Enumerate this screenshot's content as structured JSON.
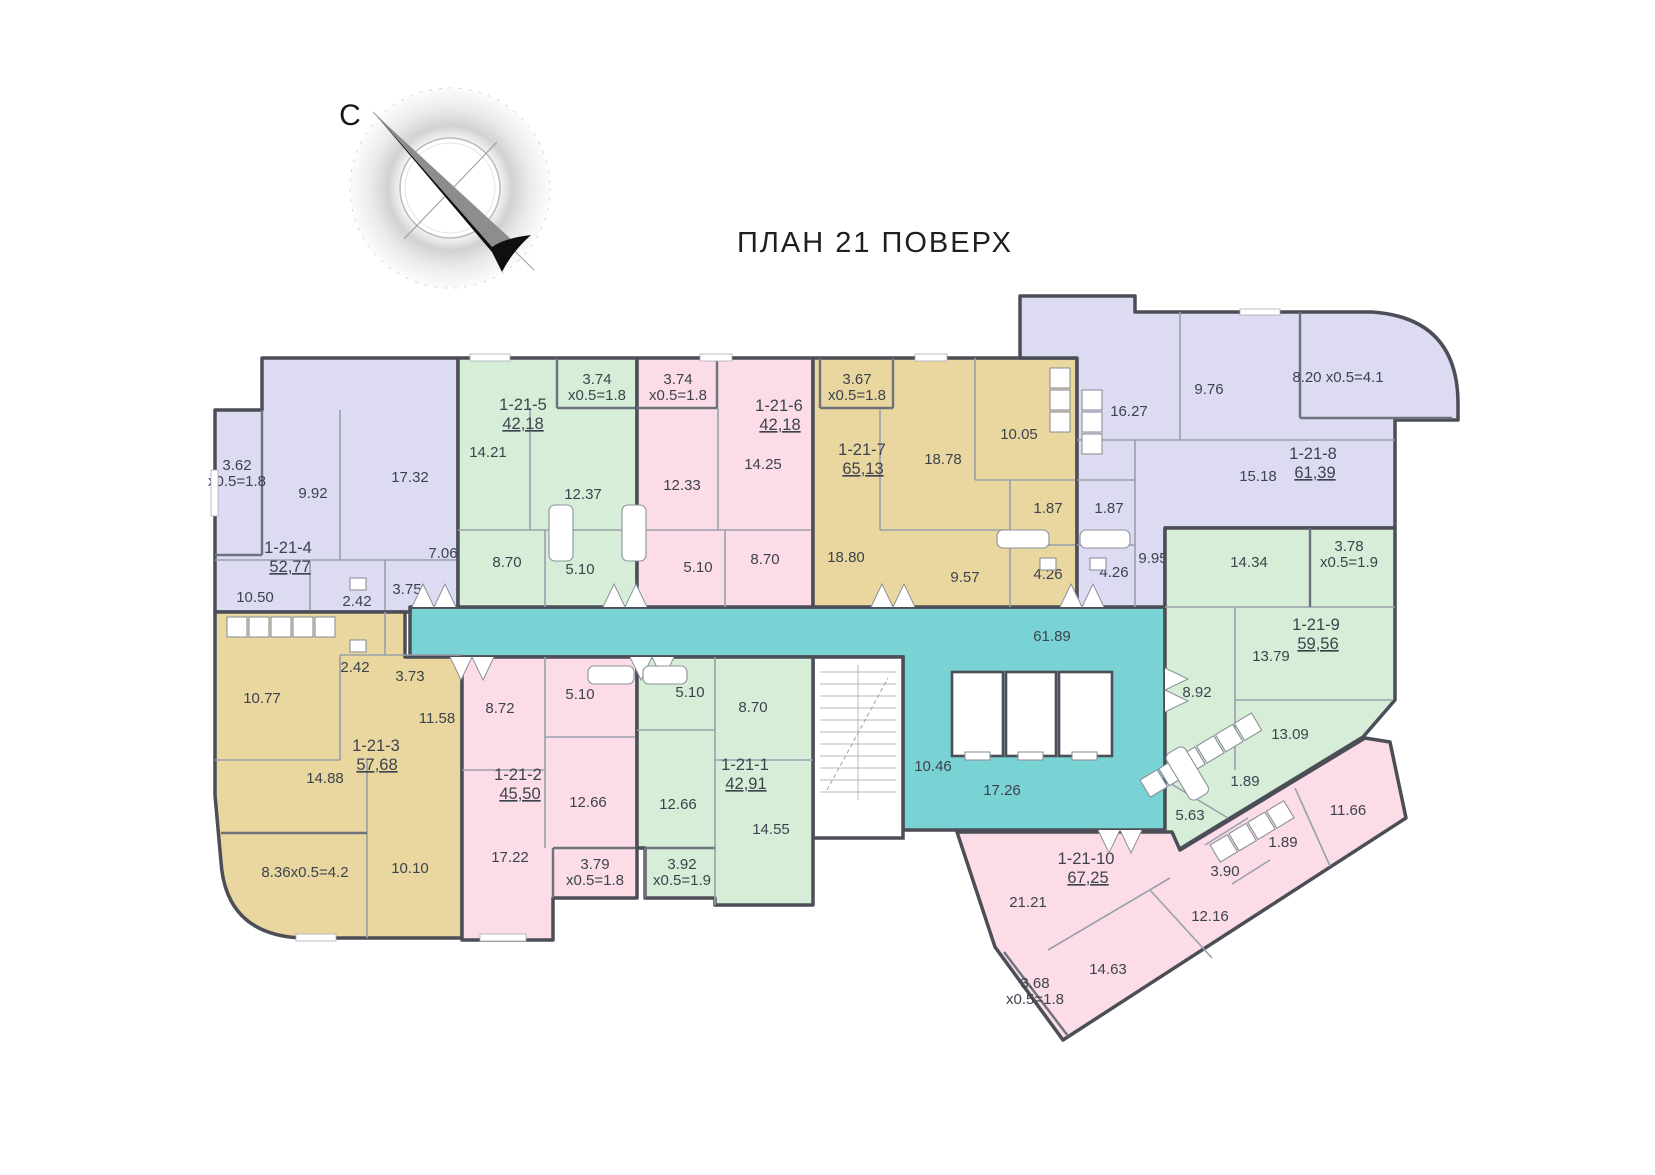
{
  "title": "ПЛАН 21 ПОВЕРХ",
  "compass": {
    "north_label": "С"
  },
  "palette": {
    "corridor": "#79d2d4",
    "lavender": "#dcdbf2",
    "green": "#d6eed7",
    "pink": "#fbdce7",
    "tan": "#e9d79f",
    "wall": "#4b4e57",
    "inner_wall": "#99a0ab",
    "text": "#3d434e",
    "needle_dark": "#0f0f0f",
    "needle_gray": "#8d8d8d"
  },
  "common_areas": {
    "corridor": "61.89",
    "stair_hall": "10.46",
    "elevator_hall": "17.26"
  },
  "apartments": [
    {
      "id": "1-21-1",
      "total": "42,91",
      "rooms": [
        "5.10",
        "8.70",
        "12.66",
        "14.55",
        "3.92",
        "x0.5=1.9"
      ]
    },
    {
      "id": "1-21-2",
      "total": "45,50",
      "rooms": [
        "8.72",
        "5.10",
        "12.66",
        "17.22",
        "3.79",
        "x0.5=1.8"
      ]
    },
    {
      "id": "1-21-3",
      "total": "57,68",
      "rooms": [
        "10.77",
        "2.42",
        "3.73",
        "11.58",
        "14.88",
        "10.10",
        "8.36x0.5=4.2"
      ]
    },
    {
      "id": "1-21-4",
      "total": "52,77",
      "rooms": [
        "3.62",
        "x0.5=1.8",
        "9.92",
        "17.32",
        "7.06",
        "10.50",
        "2.42",
        "3.75"
      ]
    },
    {
      "id": "1-21-5",
      "total": "42,18",
      "rooms": [
        "3.74",
        "x0.5=1.8",
        "14.21",
        "12.37",
        "8.70",
        "5.10"
      ]
    },
    {
      "id": "1-21-6",
      "total": "42,18",
      "rooms": [
        "3.74",
        "x0.5=1.8",
        "12.33",
        "14.25",
        "8.70",
        "5.10"
      ]
    },
    {
      "id": "1-21-7",
      "total": "65,13",
      "rooms": [
        "3.67",
        "x0.5=1.8",
        "18.80",
        "18.78",
        "9.57",
        "10.05",
        "1.87",
        "4.26"
      ]
    },
    {
      "id": "1-21-8",
      "total": "61,39",
      "rooms": [
        "16.27",
        "9.76",
        "8.20 x0.5=4.1",
        "15.18",
        "9.95",
        "1.87",
        "4.26"
      ]
    },
    {
      "id": "1-21-9",
      "total": "59,56",
      "rooms": [
        "14.34",
        "3.78",
        "x0.5=1.9",
        "13.79",
        "8.92",
        "13.09",
        "5.63",
        "1.89"
      ]
    },
    {
      "id": "1-21-10",
      "total": "67,25",
      "rooms": [
        "21.21",
        "14.63",
        "12.16",
        "11.66",
        "3.90",
        "1.89",
        "3.68",
        "x0.5=1.8"
      ]
    }
  ]
}
